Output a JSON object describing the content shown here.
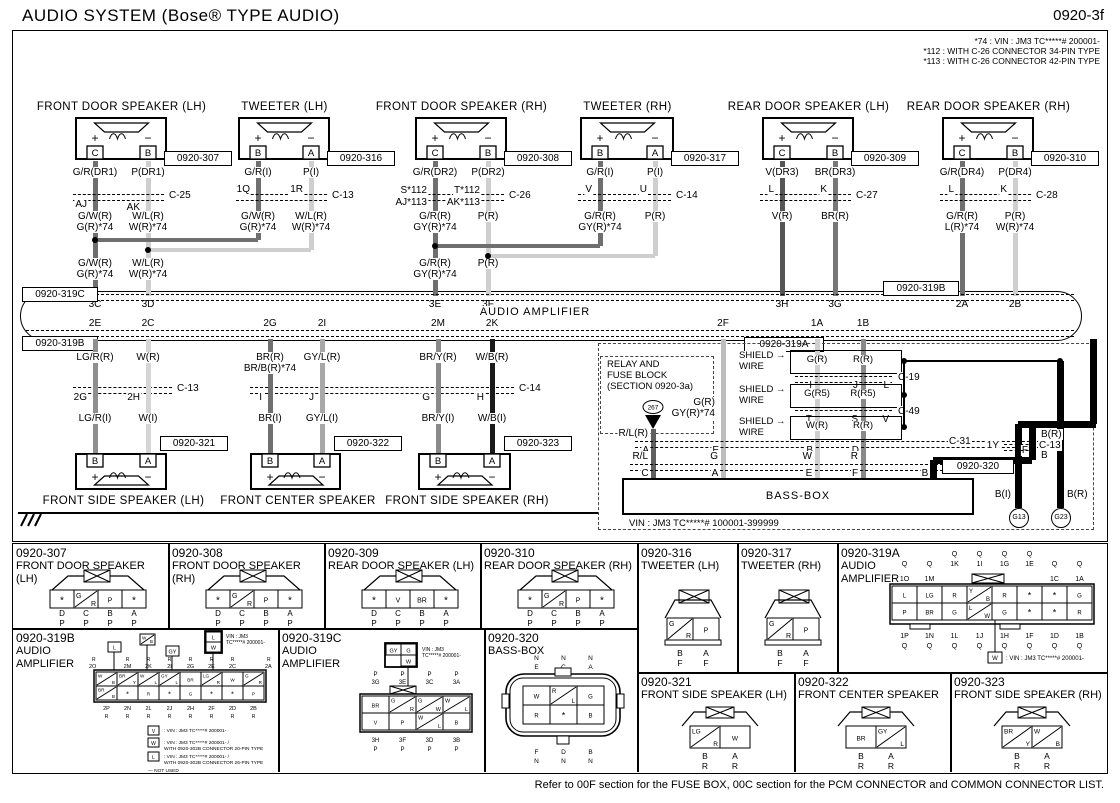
{
  "header": {
    "title": "AUDIO SYSTEM (Bose® TYPE AUDIO)",
    "page": "0920-3f"
  },
  "notes": [
    "*74 : VIN : JM3 TC*****# 200001-",
    "*112 : WITH C-26 CONNECTOR 34-PIN TYPE",
    "*113 : WITH C-26 CONNECTOR 42-PIN TYPE"
  ],
  "symbols": {
    "plus": "+",
    "minus": "−"
  },
  "amplifier": {
    "label": "AUDIO AMPLIFIER",
    "ref_top_left": "0920-319C",
    "ref_bottom_left": "0920-319B",
    "ref_top_right": "0920-319B",
    "ref_bottom_right": "0920-319A",
    "top_pins": [
      "3C",
      "3D",
      "3E",
      "3F",
      "3H",
      "3G",
      "2A",
      "2B"
    ],
    "bottom_pins": [
      "2E",
      "2C",
      "2G",
      "2I",
      "2M",
      "2K",
      "2F",
      "1A",
      "1B"
    ]
  },
  "top_speakers": [
    {
      "name": "FRONT DOOR SPEAKER (LH)",
      "ref": "0920-307",
      "pin_left": "C",
      "pin_right": "B",
      "wire_top": [
        "G/R(DR1)",
        "P(DR1)"
      ],
      "conn": "C-25",
      "conn_pins": [
        "AJ",
        "AK"
      ],
      "wire_mid": [
        [
          "G/W(R)",
          "G(R)*74"
        ],
        [
          "W/L(R)",
          "W(R)*74"
        ]
      ],
      "wire_low": [
        [
          "G/W(R)",
          "G(R)*74"
        ],
        [
          "W/L(R)",
          "W(R)*74"
        ]
      ]
    },
    {
      "name": "TWEETER (LH)",
      "ref": "0920-316",
      "pin_left": "B",
      "pin_right": "A",
      "wire_top": [
        "G/R(I)",
        "P(I)"
      ],
      "conn": "C-13",
      "conn_pins": [
        "1Q",
        "1R"
      ],
      "wire_mid": [
        [
          "G/W(R)",
          "G(R)*74"
        ],
        [
          "W/L(R)",
          "W(R)*74"
        ]
      ]
    },
    {
      "name": "FRONT DOOR SPEAKER (RH)",
      "ref": "0920-308",
      "pin_left": "C",
      "pin_right": "B",
      "wire_top": [
        "G/R(DR2)",
        "P(DR2)"
      ],
      "conn": "C-26",
      "conn_pins_stacked": [
        [
          "S*112",
          "AJ*113"
        ],
        [
          "T*112",
          "AK*113"
        ]
      ],
      "wire_mid": [
        [
          "G/R(R)",
          "GY(R)*74"
        ],
        [
          "P(R)"
        ]
      ],
      "wire_low": [
        [
          "G/R(R)",
          "GY(R)*74"
        ],
        [
          "P(R)"
        ]
      ]
    },
    {
      "name": "TWEETER (RH)",
      "ref": "0920-317",
      "pin_left": "B",
      "pin_right": "A",
      "wire_top": [
        "G/R(I)",
        "P(I)"
      ],
      "conn": "C-14",
      "conn_pins": [
        "V",
        "U"
      ],
      "wire_mid": [
        [
          "G/R(R)",
          "GY(R)*74"
        ],
        [
          "P(R)"
        ]
      ]
    },
    {
      "name": "REAR DOOR SPEAKER (LH)",
      "ref": "0920-309",
      "pin_left": "C",
      "pin_right": "B",
      "wire_top": [
        "V(DR3)",
        "BR(DR3)"
      ],
      "conn": "C-27",
      "conn_pins": [
        "L",
        "K"
      ],
      "wire_mid": [
        [
          "V(R)"
        ],
        [
          "BR(R)"
        ]
      ]
    },
    {
      "name": "REAR DOOR SPEAKER (RH)",
      "ref": "0920-310",
      "pin_left": "C",
      "pin_right": "B",
      "wire_top": [
        "G/R(DR4)",
        "P(DR4)"
      ],
      "conn": "C-28",
      "conn_pins": [
        "L",
        "K"
      ],
      "wire_mid": [
        [
          "G/R(R)",
          "L(R)*74"
        ],
        [
          "P(R)",
          "W(R)*74"
        ]
      ]
    }
  ],
  "bottom_speakers": [
    {
      "name": "FRONT SIDE SPEAKER (LH)",
      "ref": "0920-321",
      "pin_left": "B",
      "pin_right": "A",
      "wire_top": [
        [
          "LG/R(R)"
        ],
        [
          "W(R)"
        ]
      ],
      "conn": "C-13",
      "conn_pins": [
        "2G",
        "2H"
      ],
      "wire_low": [
        "LG/R(I)",
        "W(I)"
      ]
    },
    {
      "name": "FRONT CENTER SPEAKER",
      "ref": "0920-322",
      "pin_left": "B",
      "pin_right": "A",
      "wire_top": [
        [
          "BR(R)",
          "BR/B(R)*74"
        ],
        [
          "GY/L(R)"
        ]
      ],
      "conn": "C-14",
      "conn_pins": [
        "I",
        "J"
      ],
      "wire_low": [
        "BR(I)",
        "GY/L(I)"
      ]
    },
    {
      "name": "FRONT SIDE SPEAKER (RH)",
      "ref": "0920-323",
      "pin_left": "B",
      "pin_right": "A",
      "wire_top": [
        [
          "BR/Y(R)"
        ],
        [
          "W/B(R)"
        ]
      ],
      "conn": "C-14",
      "conn_pins": [
        "G",
        "H"
      ],
      "wire_low": [
        "BR/Y(I)",
        "W/B(I)"
      ]
    }
  ],
  "relay_block": {
    "line1": "RELAY AND",
    "line2": "FUSE BLOCK",
    "line3": "(SECTION 0920-3a)",
    "fuse": "267"
  },
  "right_section": {
    "wire_rl": "R/L(R)",
    "wire_2f": [
      "G(R)",
      "GY(R)*74"
    ],
    "shield_label": [
      "SHIELD →",
      "WIRE"
    ],
    "shield_boxes": [
      {
        "wires": [
          "G(R)",
          "R(R)"
        ],
        "pins": [
          "I",
          "J",
          "L"
        ],
        "conn": "C-19"
      },
      {
        "wires": [
          "G(R5)",
          "R(R5)"
        ],
        "pins": [
          "T",
          "S",
          "V"
        ],
        "conn": "C-49"
      },
      {
        "wires": [
          "W(R)",
          "R(R)"
        ],
        "pins": [],
        "conn": ""
      }
    ],
    "c31": {
      "label": "C-31",
      "pins": [
        "A",
        "E",
        "B",
        "D",
        "F"
      ]
    },
    "wires_to_bass": [
      "R/L",
      "G",
      "W",
      "R",
      "B"
    ],
    "bass": {
      "ref": "0920-320",
      "label": "BASS-BOX",
      "pins": [
        "C",
        "A",
        "E",
        "F",
        "B"
      ]
    },
    "b_r_top": "B(R)",
    "pin_1y": "1Y",
    "conn_1y": "C-13",
    "b_i": "B(I)",
    "b_r": "B(R)",
    "grounds": [
      "G13",
      "G23"
    ],
    "vin_note": "VIN : JM3 TC*****# 100001-399999"
  },
  "connector_table": {
    "cells": [
      {
        "id": "0920-307",
        "name": "FRONT DOOR SPEAKER (LH)",
        "type": "door4",
        "cells": [
          "*",
          "G/R",
          "P",
          "*"
        ],
        "pins": [
          "D",
          "C",
          "B",
          "A"
        ],
        "codes": [
          "P",
          "P",
          "P",
          "P"
        ]
      },
      {
        "id": "0920-308",
        "name": "FRONT DOOR SPEAKER (RH)",
        "type": "door4",
        "cells": [
          "*",
          "G/R",
          "P",
          "*"
        ],
        "pins": [
          "D",
          "C",
          "B",
          "A"
        ],
        "codes": [
          "P",
          "P",
          "P",
          "P"
        ]
      },
      {
        "id": "0920-309",
        "name": "REAR DOOR SPEAKER (LH)",
        "type": "door4",
        "cells": [
          "*",
          "V",
          "BR",
          "*"
        ],
        "pins": [
          "D",
          "C",
          "B",
          "A"
        ],
        "codes": [
          "P",
          "P",
          "P",
          "P"
        ]
      },
      {
        "id": "0920-310",
        "name": "REAR DOOR SPEAKER (RH)",
        "type": "door4",
        "cells": [
          "*",
          "G/R",
          "P",
          "*"
        ],
        "pins": [
          "D",
          "C",
          "B",
          "A"
        ],
        "codes": [
          "P",
          "P",
          "P",
          "P"
        ]
      },
      {
        "id": "0920-316",
        "name": "TWEETER (LH)",
        "type": "tweeter",
        "cells": [
          "G/R",
          "P"
        ],
        "pins": [
          "B",
          "A"
        ],
        "codes": [
          "F",
          "F"
        ]
      },
      {
        "id": "0920-317",
        "name": "TWEETER (RH)",
        "type": "tweeter",
        "cells": [
          "G/R",
          "P"
        ],
        "pins": [
          "B",
          "A"
        ],
        "codes": [
          "F",
          "F"
        ]
      },
      {
        "id": "0920-319A",
        "name": "AUDIO AMPLIFIER",
        "type": "amp319a",
        "q_top": [
          "Q",
          "Q",
          "Q",
          "Q"
        ],
        "q_mid": [
          "Q",
          "Q",
          "1K",
          "1I",
          "1G",
          "1E",
          "Q",
          "Q"
        ],
        "ids_outer": [
          "1O",
          "1M",
          "",
          "",
          "",
          "",
          "1C",
          "1A"
        ],
        "row1": [
          "L",
          "LG",
          "R",
          "Y/B",
          "R",
          "*",
          "*",
          "G"
        ],
        "row2": [
          "P",
          "BR",
          "G",
          "L/W",
          "G",
          "*",
          "*",
          "R"
        ],
        "bottom_pins": [
          "1P",
          "1N",
          "1L",
          "1J",
          "1H",
          "1F",
          "1D",
          "1B"
        ],
        "bottom_codes": [
          "Q",
          "Q",
          "Q",
          "Q",
          "Q",
          "Q",
          "Q",
          "Q"
        ],
        "note_cell": "W",
        "note": ": VIN : JM3 TC*****# 200001-"
      },
      {
        "id": "0920-319B",
        "name": "AUDIO AMPLIFIER",
        "type": "amp319b",
        "inset_cells": [
          "L",
          "W/B",
          "GY",
          "L",
          "W"
        ],
        "inset_note": [
          "VIN : JM3",
          "TC*****# 200001-"
        ],
        "top_codes": [
          "R",
          "R",
          "R",
          "R",
          "R",
          "R"
        ],
        "top_pins": [
          "2M",
          "2K",
          "2I",
          "2G",
          "2E",
          "2C"
        ],
        "left_code": "R",
        "left_pin": "2O",
        "right_code": "R",
        "right_pin": "2A",
        "row1": [
          "W/B",
          "BR/Y",
          "W/L",
          "GY/L",
          "BR",
          "LG/R",
          "W",
          "G/R"
        ],
        "row2": [
          "BR/B",
          "*",
          "R",
          "*",
          "G",
          "*",
          "*",
          "P"
        ],
        "bottom_pins": [
          "2P",
          "2N",
          "2L",
          "2J",
          "2H",
          "2F",
          "2D",
          "2B"
        ],
        "bottom_codes": [
          "R",
          "R",
          "R",
          "R",
          "R",
          "R",
          "R",
          "R"
        ],
        "notes": [
          {
            "cell": "V",
            "lines": [
              ": VIN : JM3 TC*****# 200001-"
            ]
          },
          {
            "cell": "W",
            "lines": [
              ": VIN : JM3 TC*****# 200001- /",
              "WITH 0920-302B CONNECTOR 20-PIN TYPE"
            ]
          },
          {
            "cell": "L",
            "lines": [
              ": VIN : JM3 TC*****# 200001- /",
              "WITH 0920-302B CONNECTOR 26-PIN TYPE"
            ]
          },
          {
            "cell": "",
            "lines": [
              "— NOT USED"
            ]
          }
        ]
      },
      {
        "id": "0920-319C",
        "name": "AUDIO AMPLIFIER",
        "type": "amp319c",
        "inset_cells": [
          "GY",
          "G",
          "W"
        ],
        "inset_note": [
          "VIN : JM3",
          "TC*****# 200001-"
        ],
        "top_codes": [
          "P",
          "P",
          "P",
          "P"
        ],
        "top_pins": [
          "3G",
          "3E",
          "3C",
          "3A"
        ],
        "row1": [
          "BR",
          "G/R",
          "G/W",
          "W/L"
        ],
        "row2": [
          "V",
          "P",
          "W/L",
          "B"
        ],
        "bottom_pins": [
          "3H",
          "3F",
          "3D",
          "3B"
        ],
        "bottom_codes": [
          "P",
          "P",
          "P",
          "P"
        ]
      },
      {
        "id": "0920-320",
        "name": "BASS-BOX",
        "type": "bassbox",
        "top_codes": [
          "N",
          "N",
          "N"
        ],
        "top_pins": [
          "E",
          "C",
          "A"
        ],
        "row1": [
          "W",
          "R/L",
          "G"
        ],
        "row2": [
          "R",
          "*",
          "B"
        ],
        "bottom_pins": [
          "F",
          "D",
          "B"
        ],
        "bottom_codes": [
          "N",
          "N",
          "N"
        ]
      },
      {
        "id": "0920-321",
        "name": "FRONT SIDE SPEAKER (LH)",
        "type": "side2",
        "cells": [
          "LG/R",
          "W"
        ],
        "pins": [
          "B",
          "A"
        ],
        "codes": [
          "R",
          "R"
        ]
      },
      {
        "id": "0920-322",
        "name": "FRONT CENTER SPEAKER",
        "type": "side2",
        "cells": [
          "BR",
          "GY/L"
        ],
        "pins": [
          "B",
          "A"
        ],
        "codes": [
          "R",
          "R"
        ]
      },
      {
        "id": "0920-323",
        "name": "FRONT SIDE SPEAKER (RH)",
        "type": "side2",
        "cells": [
          "BR/Y",
          "W/B"
        ],
        "pins": [
          "B",
          "A"
        ],
        "codes": [
          "R",
          "R"
        ]
      }
    ]
  },
  "footer": "Refer to 00F section for the FUSE BOX, 00C section for the PCM CONNECTOR and COMMON CONNECTOR LIST."
}
